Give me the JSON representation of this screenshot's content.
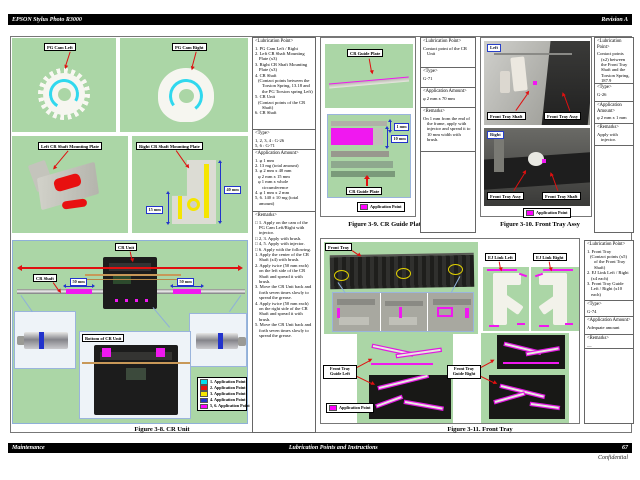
{
  "page": {
    "header": {
      "left": "EPSON Stylus Photo R3000",
      "right": "Revision A"
    },
    "footer": {
      "left": "Maintenance",
      "center": "Lubrication Points and Instructions",
      "page_number": "67",
      "confidential": "Confidential"
    }
  },
  "colors": {
    "application_magenta": "#ff00ff",
    "cyan": "#30d8ee",
    "red": "#e01010",
    "yellow": "#f5e500",
    "blue": "#2233cc",
    "panel_green": "#abd6a6"
  },
  "fig3_8": {
    "caption": "Figure 3-8.  CR Unit",
    "pg_cam_left_label": "PG Cam Left",
    "pg_cam_right_label": "PG Cam Right",
    "left_plate_label": "Left CR Shaft Mounting Plate",
    "right_plate_label": "Right CR Shaft Mounting Plate",
    "plate_dim_40": "40 mm",
    "plate_dim_15": "15 mm",
    "cr_unit_label": "CR Unit",
    "cr_shaft_label": "CR Shaft",
    "dim_50_left": "50 mm",
    "dim_50_right": "50 mm",
    "bottom_label": "Bottom of CR Unit",
    "legend": [
      {
        "swatch": "#00e0f0",
        "label": "1. Application Point"
      },
      {
        "swatch": "#e81010",
        "label": "2. Application Point"
      },
      {
        "swatch": "#f5e500",
        "label": "3. Application Point"
      },
      {
        "swatch": "#2233cc",
        "label": "4. Application Point"
      },
      {
        "swatch": "#ff00ff",
        "label": "5, 6. Application Point"
      }
    ]
  },
  "spec3_8": {
    "sections": [
      {
        "header": "<Lubrication Point>",
        "lines": [
          "1. PG Cam Left / Right",
          "2. Left CR Shaft Mounting Plate (x3)",
          "3. Right CR Shaft Mounting Plate (x3)",
          "4. CR Shaft",
          {
            "label": "(Contact points between the Torsion Spring, 13.18 and the PG Torsion spring Left)",
            "indent": true
          },
          "5. CR Unit",
          {
            "label": "(Contact points of the CR Shaft)",
            "indent": true
          },
          "6. CR Shaft"
        ]
      },
      {
        "header": "<Type>",
        "lines": [
          "1, 2, 3, 4 : G-26",
          "5, 6 : G-71"
        ]
      },
      {
        "header": "<Application Amount>",
        "lines": [
          "1. φ 1 mm",
          "2. 13 mg (total amount)",
          "3. φ 2 mm x 40 mm",
          {
            "label": "φ 2 mm x 15 mm",
            "indent": true
          },
          {
            "label": "φ 1 mm x whole circumference",
            "indent": true
          },
          "4. φ 1 mm x 2 mm",
          "5, 6. 140 ± 10 mg (total amount)"
        ]
      },
      {
        "header": "<Remarks>",
        "lines": [
          "□ 1. Apply on the cam of the PG Cam Left/Right with injector.",
          "□ 2, 3. Apply with brush.",
          "□ 4, 5. Apply with injector.",
          "□ 6. Apply with the following.",
          "1. Apply the center of the CR Shaft (x4) with brush.",
          "2. Apply twice (50 mm each) on the left side of the CR Shaft and spread it with brush.",
          "3. Move the CR Unit back and forth seven times slowly to spread the grease.",
          "4. Apply twice (50 mm each) on the right side of the CR Shaft and spread it with brush.",
          "5. Move the CR Unit back and forth seven times slowly to spread the grease."
        ]
      }
    ]
  },
  "fig3_9": {
    "caption": "Figure 3-9.  CR Guide Plate",
    "plate_label": "CR Guide Plate",
    "detail_plate_label": "CR Guide Plate",
    "dim_1": "1 mm",
    "dim_10": "10 mm",
    "legend": [
      {
        "swatch": "#ff00ff",
        "label": "Application Point"
      }
    ]
  },
  "spec3_9": {
    "sections": [
      {
        "header": "<Lubrication Point>",
        "lines": [
          "Contact point of the CR Unit"
        ]
      },
      {
        "header": "<Type>",
        "lines": [
          "G-71"
        ]
      },
      {
        "header": "<Application Amount>",
        "lines": [
          "φ 2 mm x 70 mm"
        ]
      },
      {
        "header": "<Remarks>",
        "lines": [
          "On 1 mm from the end of the frame, apply with injector and spread it to 10 mm width with brush."
        ]
      }
    ]
  },
  "fig3_10": {
    "caption": "Figure 3-10.  Front Tray Assy",
    "badge_left": "Left",
    "badge_right": "Right",
    "left_labels": [
      "Front Tray Shaft",
      "Front Tray Assy"
    ],
    "right_labels": [
      "Front Tray Assy",
      "Front Tray Shaft"
    ],
    "legend": [
      {
        "swatch": "#ff00ff",
        "label": "Application Point"
      }
    ]
  },
  "spec3_10": {
    "sections": [
      {
        "header": "<Lubrication Point>",
        "lines": [
          "Contact points (x2) between the Front Tray Shaft and the Torsion Spring, 187.9"
        ]
      },
      {
        "header": "<Type>",
        "lines": [
          "G-26"
        ]
      },
      {
        "header": "<Application Amount>",
        "lines": [
          "φ 2 mm x 1 mm"
        ]
      },
      {
        "header": "<Remarks>",
        "lines": [
          "Apply with injector."
        ]
      }
    ]
  },
  "fig3_11": {
    "caption": "Figure 3-11.  Front Tray",
    "front_tray_label": "Front Tray",
    "ej_link_left_label": "EJ Link Left",
    "ej_link_right_label": "EJ Link Right",
    "guide_left_label": "Front Tray Guide Left",
    "guide_right_label": "Front Tray Guide Right",
    "legend": [
      {
        "swatch": "#ff00ff",
        "label": "Application Point"
      }
    ]
  },
  "spec3_11": {
    "sections": [
      {
        "header": "<Lubrication Point>",
        "lines": [
          "1. Front Tray",
          {
            "label": "(Contact points (x5) of the Front Tray Shaft)",
            "indent": true
          },
          "2. EJ Link Left / Right (x4 each)",
          "3. Front Tray Guide Left / Right (x10 each)"
        ]
      },
      {
        "header": "<Type>",
        "lines": [
          "G-74"
        ]
      },
      {
        "header": "<Application Amount>",
        "lines": [
          "Adequate amount"
        ]
      },
      {
        "header": "<Remarks>",
        "lines": [
          "—"
        ]
      }
    ]
  }
}
